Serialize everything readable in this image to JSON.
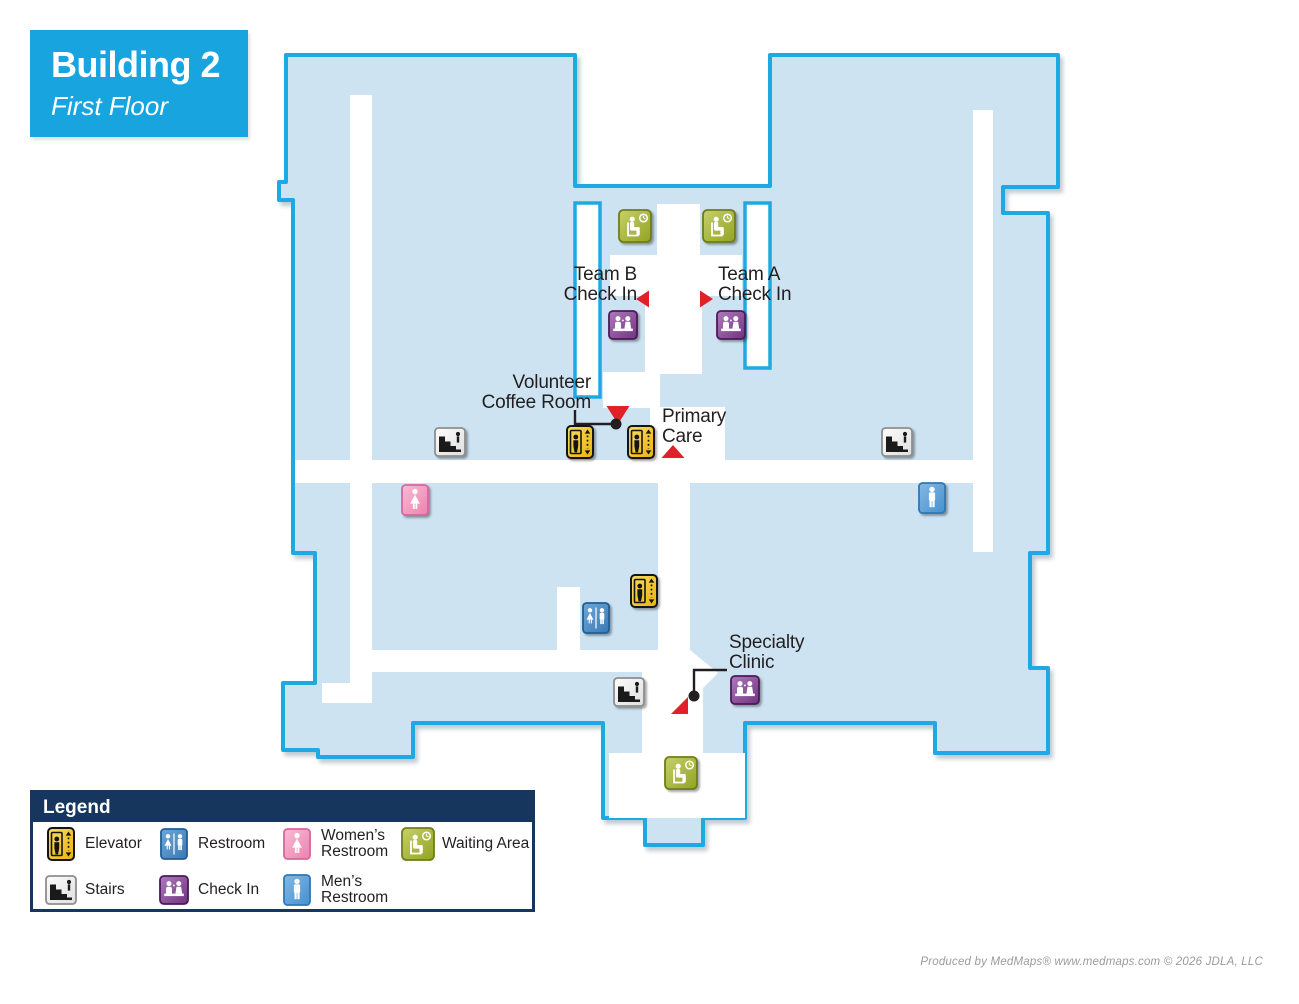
{
  "title": {
    "line1": "Building 2",
    "line2": "First Floor"
  },
  "map": {
    "labels": {
      "team_b": "Team B\nCheck In",
      "team_a": "Team A\nCheck In",
      "volunteer": "Volunteer\nCoffee Room",
      "primary": "Primary\nCare",
      "specialty": "Specialty\nClinic"
    },
    "icons": [
      {
        "type": "waiting",
        "x": 635,
        "y": 226
      },
      {
        "type": "waiting",
        "x": 719,
        "y": 226
      },
      {
        "type": "checkin",
        "x": 623,
        "y": 325
      },
      {
        "type": "checkin",
        "x": 731,
        "y": 325
      },
      {
        "type": "stairs",
        "x": 450,
        "y": 442
      },
      {
        "type": "elevator",
        "x": 580,
        "y": 442
      },
      {
        "type": "elevator",
        "x": 641,
        "y": 442
      },
      {
        "type": "stairs",
        "x": 897,
        "y": 442
      },
      {
        "type": "womens",
        "x": 415,
        "y": 500
      },
      {
        "type": "mens",
        "x": 932,
        "y": 498
      },
      {
        "type": "elevator",
        "x": 644,
        "y": 591
      },
      {
        "type": "restroom",
        "x": 596,
        "y": 618
      },
      {
        "type": "stairs",
        "x": 629,
        "y": 692
      },
      {
        "type": "checkin",
        "x": 745,
        "y": 690
      },
      {
        "type": "waiting",
        "x": 681,
        "y": 773
      }
    ],
    "markers": [
      {
        "dir": "left",
        "tip": [
          636,
          299
        ]
      },
      {
        "dir": "right",
        "tip": [
          713,
          299
        ]
      },
      {
        "dir": "down",
        "tip": [
          618,
          424
        ]
      },
      {
        "dir": "up",
        "tip": [
          673,
          445
        ]
      },
      {
        "dir": "down-left",
        "tip": [
          671,
          714
        ]
      }
    ],
    "leaders": [
      {
        "path": [
          [
            575,
            410
          ],
          [
            575,
            424
          ],
          [
            612,
            424
          ]
        ],
        "dot": [
          616,
          424
        ]
      },
      {
        "path": [
          [
            727,
            670
          ],
          [
            694,
            670
          ],
          [
            694,
            693
          ]
        ],
        "dot": [
          694,
          696
        ]
      }
    ]
  },
  "legend": {
    "header": "Legend",
    "items": [
      {
        "icon": "elevator",
        "label": "Elevator"
      },
      {
        "icon": "restroom",
        "label": "Restroom"
      },
      {
        "icon": "womens",
        "label": "Women’s\nRestroom"
      },
      {
        "icon": "waiting",
        "label": "Waiting Area"
      },
      {
        "icon": "stairs",
        "label": "Stairs"
      },
      {
        "icon": "checkin",
        "label": "Check In"
      },
      {
        "icon": "mens",
        "label": "Men’s\nRestroom"
      }
    ]
  },
  "footer": "Produced by MedMaps®  www.medmaps.com   © 2026 JDLA, LLC",
  "palette": {
    "outline": "#1FA9E2",
    "fill": "#CDE3F2",
    "title_bg": "#18A5DF",
    "navy": "#17365D",
    "red": "#E02128",
    "ink": "#231F20",
    "footer_gray": "#9B9B9B",
    "elevator_yellow": "#F2C113",
    "stairs_gray": "#F0F0F0",
    "checkin_purple": "#8F4FA0",
    "restroom_blue": "#4E90C8",
    "womens_pink": "#F2A3C8",
    "mens_blue": "#5FA3DA",
    "waiting_green": "#A9BA45"
  }
}
